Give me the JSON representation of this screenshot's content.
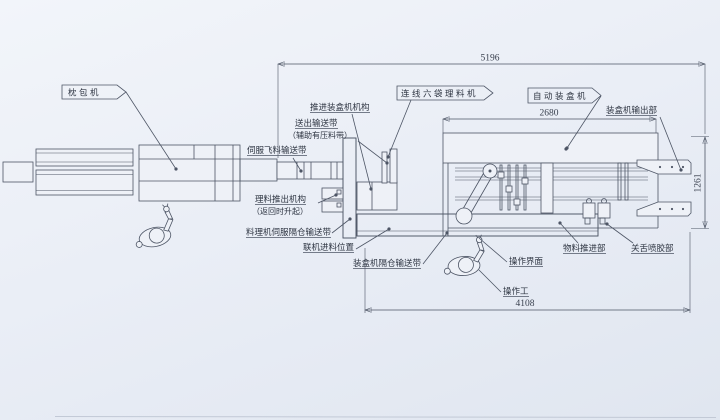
{
  "meta": {
    "type": "engineering-plan-drawing",
    "line_color": "#4d5565",
    "paper_color": "#eaeef6"
  },
  "labels": {
    "pillow_machine": "枕包机",
    "push_into_cartoner": "推进装盒机机构",
    "outfeed_belt_line1": "送出输送带",
    "outfeed_belt_line2": "（辅助有压料带）",
    "inline_six_bag_machine": "连线六袋理料机",
    "auto_cartoner": "自动装盒机",
    "cartoner_output": "装盒机输出部",
    "servo_fly_conveyor": "伺服飞料输送带",
    "pushout_line1": "理料推出机构",
    "pushout_line2": "（返回时升起）",
    "servo_compartment_conveyor": "料理机伺服隔仓输送带",
    "online_feed_position": "联机进料位置",
    "cartoner_compartment_conveyor": "装盒机隔仓输送带",
    "operation_interface": "操作界面",
    "operator": "操作工",
    "material_push_section": "物料推进部",
    "tongue_glue_section": "关舌喷胶部"
  },
  "dims": {
    "total_length": "5196",
    "cartoner_length": "2680",
    "height": "1261",
    "floor_length": "4108"
  }
}
